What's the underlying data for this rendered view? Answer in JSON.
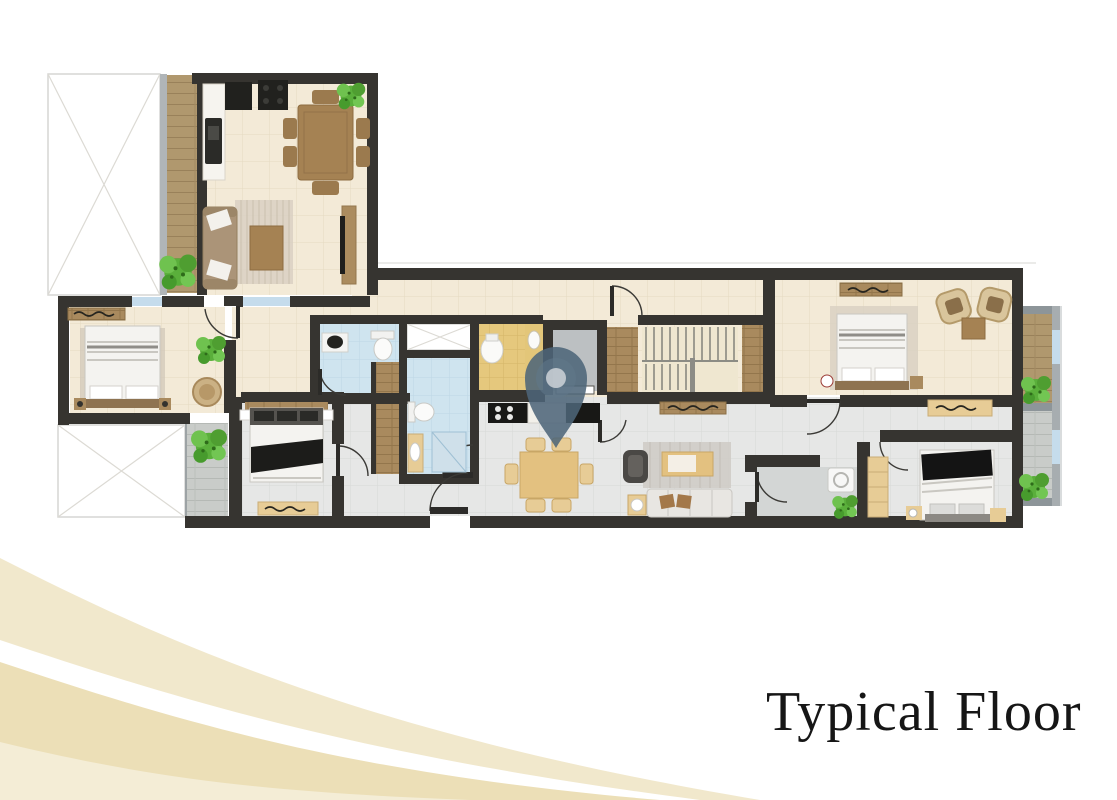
{
  "caption": {
    "title": "Typical Floor"
  },
  "overlay": {
    "pin_icon": "location-pin-icon"
  },
  "colors": {
    "background": "#ffffff",
    "wall": "#363430",
    "floor_cream": "#f3ead7",
    "tile_line_cream": "#e4dac2",
    "floor_gray": "#e6e7e6",
    "tile_line_gray": "#d7d9d7",
    "floor_blue": "#cfe4ef",
    "floor_yellow": "#e5c87d",
    "deck_wood": "#b0986e",
    "deck_gray": "#c9ccc9",
    "furniture_wood": "#a98a5e",
    "light_wood": "#e7cc96",
    "window_blue": "#c5dcec",
    "plant_green": "#5db23c",
    "pin_blue": "#4d6579",
    "wave_cream": "#f1e8cc",
    "wave_tan": "#ecdfb7",
    "outline_gray": "#d6d6d4",
    "text_dark": "#161616"
  }
}
